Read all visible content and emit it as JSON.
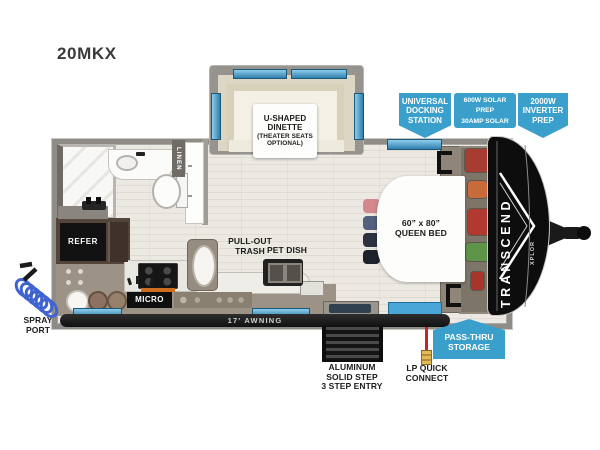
{
  "title": "20MKX",
  "plan": {
    "dinette_name": "U-SHAPED\nDINETTE",
    "dinette_option": "(THEATER SEATS\nOPTIONAL)",
    "linen": "LINEN",
    "refer": "REFER",
    "micro": "MICRO",
    "pullout_trash": "PULL-OUT\nTRASH",
    "pet_dish": "PET DISH",
    "queen_bed": "60” x 80”\nQUEEN BED",
    "awning": "17' AWNING"
  },
  "exterior": {
    "spray_port": "SPRAY\nPORT",
    "steps": "ALUMINUM\nSOLID STEP\n3 STEP ENTRY",
    "lp_quick_connect": "LP QUICK\nCONNECT"
  },
  "callouts": {
    "docking": "UNIVERSAL\nDOCKING\nSTATION",
    "solar": "600W SOLAR PREP\n30AMP SOLAR\nCONTROL PREP",
    "inverter": "2000W\nINVERTER\nPREP",
    "passthru": "PASS-THRU\nSTORAGE"
  },
  "branding": {
    "model": "TRANSCEND",
    "series": "XPLOR"
  },
  "colors": {
    "callout_blue": "#3aa0cb",
    "window_blue": "#4fabda",
    "lp_red": "#c92323",
    "spray_hose_blue": "#3f63cf",
    "floor_beige": "#e9e6e0",
    "wall_gray": "#8f8c88",
    "counter_taupe": "#9c9285",
    "accent_orange": "#cf6d1f"
  }
}
